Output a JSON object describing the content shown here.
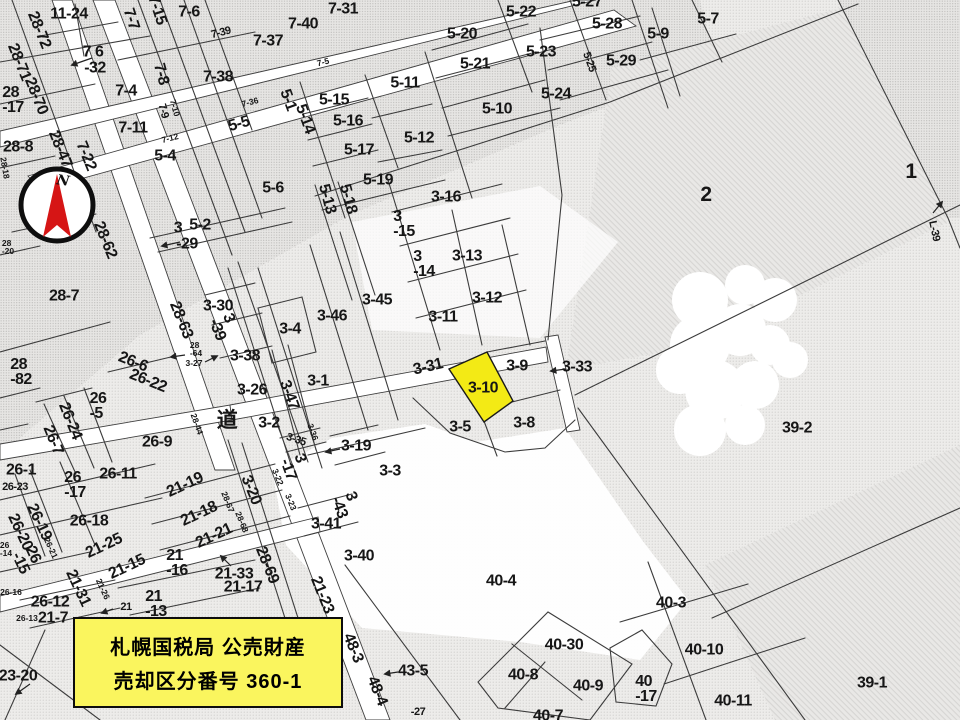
{
  "map": {
    "description": "Japanese cadastral parcel map (scanned)",
    "accent_yellow": "#f3ea15",
    "box_yellow": "#faf55e",
    "needle_red": "#d61515",
    "highlight_parcel": {
      "label": "3-10"
    },
    "annotation_box": {
      "line1": "札幌国税局 公売財産",
      "line2": "売却区分番号 360-1"
    },
    "compass": {
      "north_label": "N"
    },
    "labels": [
      {
        "t": "11-24",
        "x": 69,
        "y": 14
      },
      {
        "t": "28-72",
        "x": 39,
        "y": 30,
        "r": 68
      },
      {
        "t": "7-7",
        "x": 131,
        "y": 19,
        "r": 72
      },
      {
        "t": "7-15",
        "x": 157,
        "y": 10,
        "r": 72
      },
      {
        "t": "7-6",
        "x": 189,
        "y": 12
      },
      {
        "t": "7-39",
        "x": 221,
        "y": 33,
        "r": -14,
        "s": "s"
      },
      {
        "t": "7-37",
        "x": 268,
        "y": 41
      },
      {
        "t": "7-40",
        "x": 303,
        "y": 24
      },
      {
        "t": "7-31",
        "x": 343,
        "y": 9
      },
      {
        "t": "7 6",
        "x": 93,
        "y": 52
      },
      {
        "t": "-32",
        "x": 95,
        "y": 68
      },
      {
        "t": "28-71",
        "x": 19,
        "y": 62,
        "r": 68
      },
      {
        "t": "28\n-17",
        "x": 13,
        "y": 100
      },
      {
        "t": "28-70",
        "x": 36,
        "y": 96,
        "r": 68
      },
      {
        "t": "7-4",
        "x": 126,
        "y": 91
      },
      {
        "t": "7-8",
        "x": 161,
        "y": 74,
        "r": 75
      },
      {
        "t": "7-38",
        "x": 218,
        "y": 77
      },
      {
        "t": "7-36",
        "x": 250,
        "y": 102,
        "r": -14,
        "s": "t"
      },
      {
        "t": "7-9",
        "x": 163,
        "y": 111,
        "r": 75,
        "s": "s"
      },
      {
        "t": "7-10",
        "x": 175,
        "y": 108,
        "r": 75,
        "s": "t"
      },
      {
        "t": "5-1",
        "x": 288,
        "y": 100,
        "r": 70
      },
      {
        "t": "5-14",
        "x": 305,
        "y": 119,
        "r": 70
      },
      {
        "t": "5-5",
        "x": 239,
        "y": 124,
        "r": -16
      },
      {
        "t": "7-11",
        "x": 133,
        "y": 128
      },
      {
        "t": "7-12",
        "x": 170,
        "y": 138,
        "r": -14,
        "s": "t"
      },
      {
        "t": "5-4",
        "x": 165,
        "y": 156
      },
      {
        "t": "7-22",
        "x": 86,
        "y": 156,
        "r": 68
      },
      {
        "t": "28-47",
        "x": 60,
        "y": 149,
        "r": 68
      },
      {
        "t": "28-8",
        "x": 18,
        "y": 147
      },
      {
        "t": "28-18",
        "x": 5,
        "y": 168,
        "r": 80,
        "s": "t"
      },
      {
        "t": "5-6",
        "x": 273,
        "y": 188
      },
      {
        "t": "28-62",
        "x": 105,
        "y": 240,
        "r": 68
      },
      {
        "t": "5-2",
        "x": 200,
        "y": 225
      },
      {
        "t": "3",
        "x": 178,
        "y": 228
      },
      {
        "t": "-29",
        "x": 187,
        "y": 244
      },
      {
        "t": "28\n-20",
        "x": 8,
        "y": 247,
        "s": "t"
      },
      {
        "t": "28-7",
        "x": 64,
        "y": 296
      },
      {
        "t": "28\n-82",
        "x": 21,
        "y": 372
      },
      {
        "t": "5-22",
        "x": 521,
        "y": 12
      },
      {
        "t": "5-27",
        "x": 587,
        "y": 2
      },
      {
        "t": "5-20",
        "x": 462,
        "y": 34
      },
      {
        "t": "5-28",
        "x": 607,
        "y": 24
      },
      {
        "t": "5-23",
        "x": 541,
        "y": 52
      },
      {
        "t": "5-29",
        "x": 621,
        "y": 61
      },
      {
        "t": "5-21",
        "x": 475,
        "y": 64
      },
      {
        "t": "5-25",
        "x": 589,
        "y": 62,
        "r": 70,
        "s": "s"
      },
      {
        "t": "5-24",
        "x": 556,
        "y": 94
      },
      {
        "t": "5-11",
        "x": 405,
        "y": 83
      },
      {
        "t": "5-15",
        "x": 334,
        "y": 100
      },
      {
        "t": "5-10",
        "x": 497,
        "y": 109
      },
      {
        "t": "5-16",
        "x": 348,
        "y": 121
      },
      {
        "t": "5-12",
        "x": 419,
        "y": 138
      },
      {
        "t": "5-17",
        "x": 359,
        "y": 150
      },
      {
        "t": "5-19",
        "x": 378,
        "y": 180
      },
      {
        "t": "5-13",
        "x": 327,
        "y": 199,
        "r": 75
      },
      {
        "t": "5-18",
        "x": 348,
        "y": 199,
        "r": 75
      },
      {
        "t": "3-16",
        "x": 446,
        "y": 197
      },
      {
        "t": "3\n-15",
        "x": 404,
        "y": 224
      },
      {
        "t": "7-5",
        "x": 323,
        "y": 62,
        "r": -14,
        "s": "t"
      },
      {
        "t": "5-7",
        "x": 708,
        "y": 19
      },
      {
        "t": "5-9",
        "x": 658,
        "y": 34
      },
      {
        "t": "2",
        "x": 706,
        "y": 195,
        "s": "L"
      },
      {
        "t": "1",
        "x": 911,
        "y": 172,
        "s": "L"
      },
      {
        "t": "L-39",
        "x": 934,
        "y": 231,
        "r": 78,
        "s": "s"
      },
      {
        "t": "3-13",
        "x": 467,
        "y": 256
      },
      {
        "t": "3\n-14",
        "x": 424,
        "y": 264
      },
      {
        "t": "3-45",
        "x": 377,
        "y": 300
      },
      {
        "t": "3-12",
        "x": 487,
        "y": 298
      },
      {
        "t": "3-46",
        "x": 332,
        "y": 316
      },
      {
        "t": "3-11",
        "x": 443,
        "y": 317
      },
      {
        "t": "3-30",
        "x": 218,
        "y": 306
      },
      {
        "t": "3\n-39",
        "x": 224,
        "y": 327,
        "r": 68
      },
      {
        "t": "3-4",
        "x": 290,
        "y": 329
      },
      {
        "t": "28-63",
        "x": 181,
        "y": 320,
        "r": 68
      },
      {
        "t": "28\n-64",
        "x": 196,
        "y": 349,
        "s": "t"
      },
      {
        "t": "3-27",
        "x": 194,
        "y": 363,
        "s": "t"
      },
      {
        "t": "3-38",
        "x": 245,
        "y": 356
      },
      {
        "t": "26-6",
        "x": 133,
        "y": 362,
        "r": 22
      },
      {
        "t": "26-22",
        "x": 148,
        "y": 381,
        "r": 22
      },
      {
        "t": "3-26",
        "x": 252,
        "y": 390
      },
      {
        "t": "3-47",
        "x": 289,
        "y": 395,
        "r": 70
      },
      {
        "t": "3-1",
        "x": 318,
        "y": 381
      },
      {
        "t": "3-31",
        "x": 428,
        "y": 367,
        "r": -13
      },
      {
        "t": "3-9",
        "x": 517,
        "y": 366
      },
      {
        "t": "3-33",
        "x": 577,
        "y": 367
      },
      {
        "t": "3-10",
        "x": 483,
        "y": 388
      },
      {
        "t": "道",
        "x": 227,
        "y": 421,
        "s": "L"
      },
      {
        "t": "3-2",
        "x": 269,
        "y": 423
      },
      {
        "t": "26\n-5",
        "x": 98,
        "y": 406
      },
      {
        "t": "26-24",
        "x": 70,
        "y": 421,
        "r": 68
      },
      {
        "t": "26-7",
        "x": 53,
        "y": 440,
        "r": 68
      },
      {
        "t": "26-9",
        "x": 157,
        "y": 442
      },
      {
        "t": "28-44",
        "x": 197,
        "y": 424,
        "r": 70,
        "s": "t"
      },
      {
        "t": "3-35",
        "x": 296,
        "y": 440,
        "r": 18,
        "s": "s"
      },
      {
        "t": "3-36",
        "x": 313,
        "y": 432,
        "r": 70,
        "s": "t"
      },
      {
        "t": "3-5",
        "x": 460,
        "y": 427
      },
      {
        "t": "3-8",
        "x": 524,
        "y": 423
      },
      {
        "t": "3-19",
        "x": 356,
        "y": 446
      },
      {
        "t": "3\n-17",
        "x": 295,
        "y": 467,
        "r": 70
      },
      {
        "t": "3-3",
        "x": 390,
        "y": 471
      },
      {
        "t": "39-2",
        "x": 797,
        "y": 428
      },
      {
        "t": "26-1",
        "x": 21,
        "y": 470
      },
      {
        "t": "26-23",
        "x": 15,
        "y": 487,
        "s": "s"
      },
      {
        "t": "26\n-17",
        "x": 75,
        "y": 485
      },
      {
        "t": "26-11",
        "x": 118,
        "y": 474
      },
      {
        "t": "21-19",
        "x": 185,
        "y": 485,
        "r": -25
      },
      {
        "t": "3-20",
        "x": 251,
        "y": 490,
        "r": 68
      },
      {
        "t": "3-22",
        "x": 278,
        "y": 477,
        "r": 68,
        "s": "t"
      },
      {
        "t": "3-23",
        "x": 291,
        "y": 502,
        "r": 68,
        "s": "t"
      },
      {
        "t": "28-67",
        "x": 228,
        "y": 502,
        "r": 68,
        "s": "t"
      },
      {
        "t": "28-68",
        "x": 242,
        "y": 522,
        "r": 68,
        "s": "t"
      },
      {
        "t": "26-19",
        "x": 39,
        "y": 522,
        "r": 65
      },
      {
        "t": "26-20",
        "x": 20,
        "y": 532,
        "r": 65
      },
      {
        "t": "26-18",
        "x": 89,
        "y": 521
      },
      {
        "t": "26-21",
        "x": 51,
        "y": 548,
        "r": 65,
        "s": "t"
      },
      {
        "t": "21-25",
        "x": 104,
        "y": 546,
        "r": -25
      },
      {
        "t": "21-18",
        "x": 199,
        "y": 514,
        "r": -25
      },
      {
        "t": "21-21",
        "x": 214,
        "y": 536,
        "r": -25
      },
      {
        "t": "28-69",
        "x": 267,
        "y": 565,
        "r": 68
      },
      {
        "t": "3\n-43",
        "x": 346,
        "y": 505,
        "r": 70
      },
      {
        "t": "3-41",
        "x": 326,
        "y": 524
      },
      {
        "t": "26\n-15",
        "x": 27,
        "y": 560,
        "r": 65
      },
      {
        "t": "26\n-14",
        "x": 6,
        "y": 549,
        "s": "t"
      },
      {
        "t": "21-15",
        "x": 127,
        "y": 567,
        "r": -25
      },
      {
        "t": "21\n-16",
        "x": 177,
        "y": 563
      },
      {
        "t": "21-33",
        "x": 234,
        "y": 574
      },
      {
        "t": "21-17",
        "x": 243,
        "y": 587
      },
      {
        "t": "26-16",
        "x": 11,
        "y": 592,
        "s": "t"
      },
      {
        "t": "26-12",
        "x": 50,
        "y": 602
      },
      {
        "t": "21-31",
        "x": 78,
        "y": 588,
        "r": 65
      },
      {
        "t": "21-26",
        "x": 103,
        "y": 589,
        "r": 65,
        "s": "t"
      },
      {
        "t": "26-13",
        "x": 27,
        "y": 618,
        "s": "t"
      },
      {
        "t": "21-7",
        "x": 53,
        "y": 618
      },
      {
        "t": "21",
        "x": 126,
        "y": 607,
        "s": "s"
      },
      {
        "t": "21\n-13",
        "x": 156,
        "y": 604
      },
      {
        "t": "3-40",
        "x": 359,
        "y": 556
      },
      {
        "t": "21-23",
        "x": 322,
        "y": 595,
        "r": 68
      },
      {
        "t": "23-20",
        "x": 18,
        "y": 676
      },
      {
        "t": "40-4",
        "x": 501,
        "y": 581
      },
      {
        "t": "48-3",
        "x": 353,
        "y": 648,
        "r": 68
      },
      {
        "t": "48-4",
        "x": 377,
        "y": 691,
        "r": 68
      },
      {
        "t": "43-5",
        "x": 413,
        "y": 671
      },
      {
        "t": "40-3",
        "x": 671,
        "y": 603
      },
      {
        "t": "40-30",
        "x": 564,
        "y": 645
      },
      {
        "t": "40-10",
        "x": 704,
        "y": 650
      },
      {
        "t": "40-8",
        "x": 523,
        "y": 675
      },
      {
        "t": "40-9",
        "x": 588,
        "y": 686
      },
      {
        "t": "40\n-17",
        "x": 646,
        "y": 689
      },
      {
        "t": "40-11",
        "x": 733,
        "y": 701
      },
      {
        "t": "40-7",
        "x": 548,
        "y": 716
      },
      {
        "t": "39-1",
        "x": 872,
        "y": 683
      },
      {
        "t": "-27",
        "x": 418,
        "y": 712,
        "s": "s"
      }
    ]
  }
}
